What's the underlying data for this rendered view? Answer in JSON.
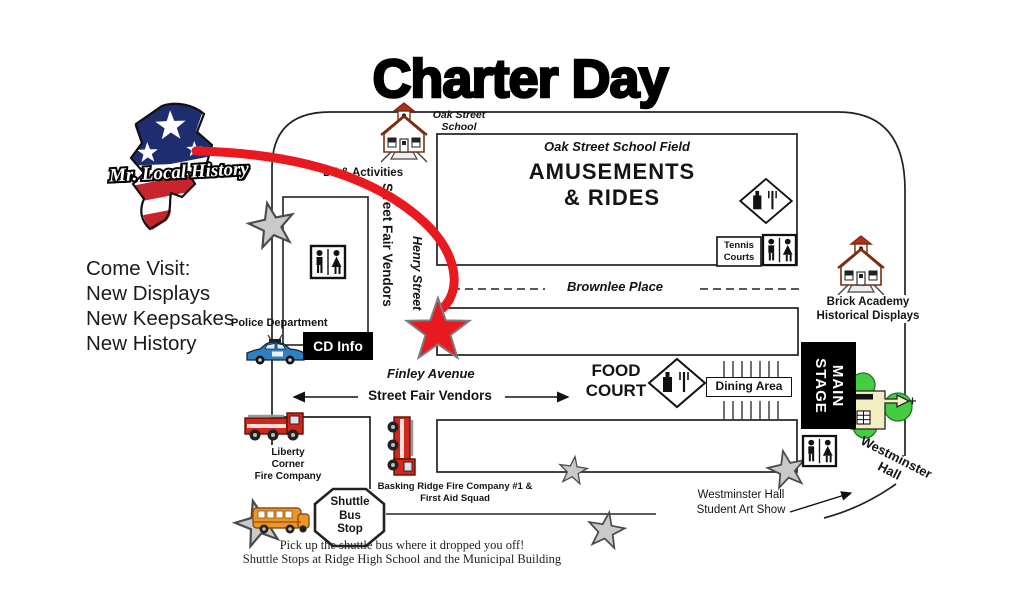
{
  "title": "Charter Day",
  "logo": {
    "text": "Mr. Local History"
  },
  "promo": {
    "heading": "Come Visit:",
    "items": [
      "New Displays",
      "New Keepsakes",
      "New History"
    ]
  },
  "map": {
    "oak_street_school": {
      "line1": "Oak Street",
      "line2": "School"
    },
    "field_label": "Oak Street School Field",
    "amusements": {
      "line1": "AMUSEMENTS",
      "line2": "& RIDES"
    },
    "tennis_courts": {
      "line1": "Tennis",
      "line2": "Courts"
    },
    "dj_activities": "DJ & Activities",
    "street_fair_vendors_vertical": "Street Fair Vendors",
    "henry_street": "Henry Street",
    "brownlee_place": "Brownlee Place",
    "police_department": "Police Department",
    "cd_info": "CD Info",
    "finley_avenue": "Finley Avenue",
    "street_fair_vendors_horizontal": "Street Fair Vendors",
    "food_court": {
      "line1": "FOOD",
      "line2": "COURT"
    },
    "dining_area": "Dining Area",
    "main_stage": {
      "line1": "MAIN",
      "line2": "STAGE"
    },
    "brick_academy": {
      "line1": "Brick Academy",
      "line2": "Historical Displays"
    },
    "westminster_hall": {
      "line1": "Westminster",
      "line2": "Hall"
    },
    "student_art_show": {
      "line1": "Westminster Hall",
      "line2": "Student Art Show"
    },
    "liberty_corner": {
      "line1": "Liberty",
      "line2": "Corner",
      "line3": "Fire Company"
    },
    "basking_ridge": {
      "line1": "Basking Ridge Fire Company #1 &",
      "line2": "First Aid Squad"
    },
    "shuttle_stop": {
      "line1": "Shuttle",
      "line2": "Bus",
      "line3": "Stop"
    }
  },
  "footer": {
    "note1": "Pick up the shuttle bus where it dropped you off!",
    "note2": "Shuttle Stops at Ridge High School and the Municipal Building"
  },
  "icons": [
    "nj-state-logo",
    "schoolhouse-icon",
    "restroom-icon",
    "food-icon",
    "police-car-icon",
    "fire-truck-icon",
    "school-bus-icon",
    "westminster-hall-icon",
    "star-marker",
    "red-star-marker",
    "route-arrow",
    "stop-octagon"
  ],
  "colors": {
    "accent_red": "#e8191f",
    "star_gray": "#c9c9c9",
    "stage_black": "#000000",
    "tree_green": "#44cc44",
    "building_cream": "#f2eec2",
    "flag_blue": "#1d2d6e",
    "flag_red": "#c8242c"
  }
}
